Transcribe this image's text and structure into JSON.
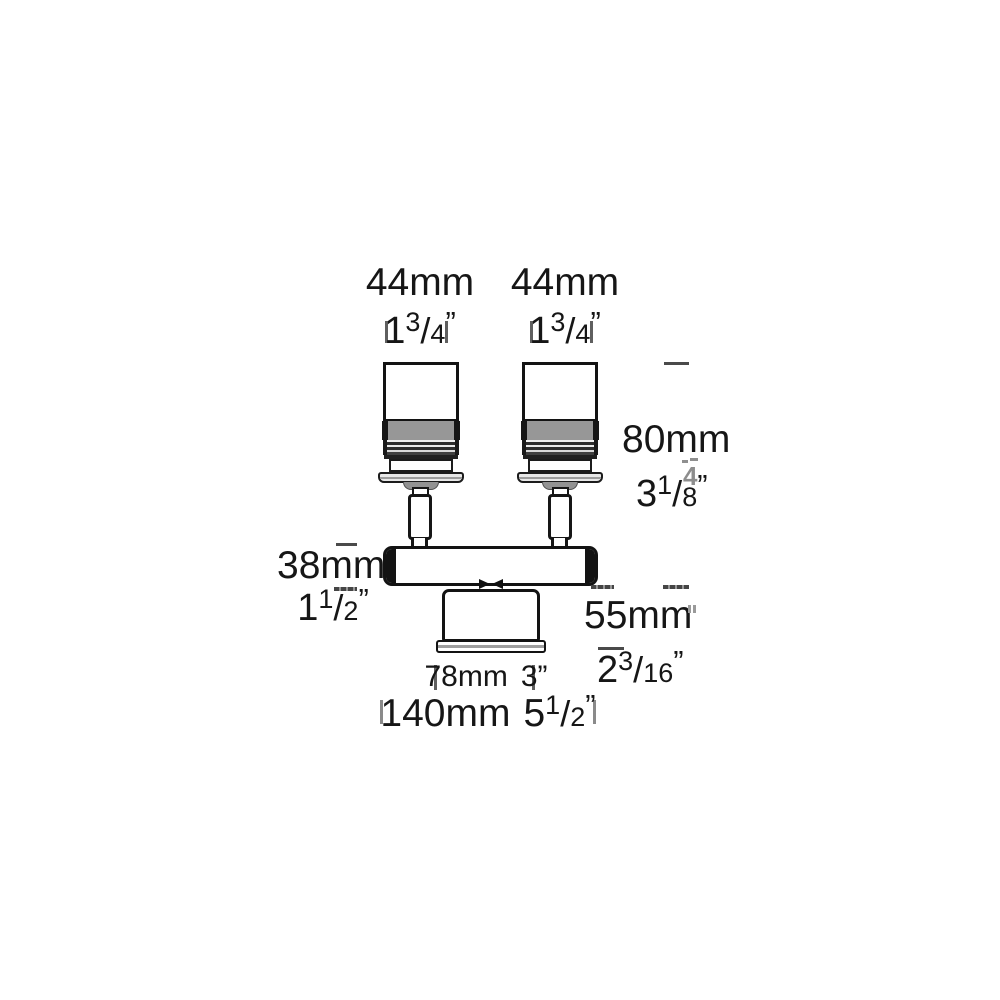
{
  "fraction_slash": "/",
  "dims": {
    "head_left": {
      "mm": "44mm",
      "whole": "1",
      "num": "3",
      "den": "4",
      "quote": "”"
    },
    "head_right": {
      "mm": "44mm",
      "whole": "1",
      "num": "3",
      "den": "4",
      "quote": "”"
    },
    "height": {
      "mm": "80mm",
      "whole": "3",
      "num": "1",
      "den": "8",
      "quote": "”"
    },
    "bar_height": {
      "mm": "38mm",
      "whole": "1",
      "num": "1",
      "den": "2",
      "quote": "”"
    },
    "drop": {
      "mm": "55mm",
      "whole": "2",
      "num": "3",
      "den": "16",
      "quote": "”"
    },
    "canopy_width": {
      "mm": "78mm",
      "inch": "3”"
    },
    "overall_width": {
      "mm": "140mm",
      "whole": "5",
      "num": "1",
      "den": "2",
      "quote": "”"
    }
  },
  "artifact": {
    "ghost_digit": "4"
  },
  "colors": {
    "line": "#131313",
    "text": "#161616",
    "band_gray": "#979797",
    "flange_gray": "#e8e8e8",
    "tick": "#4a4a4a",
    "ghost": "#8f8f8f",
    "background": "#ffffff"
  }
}
